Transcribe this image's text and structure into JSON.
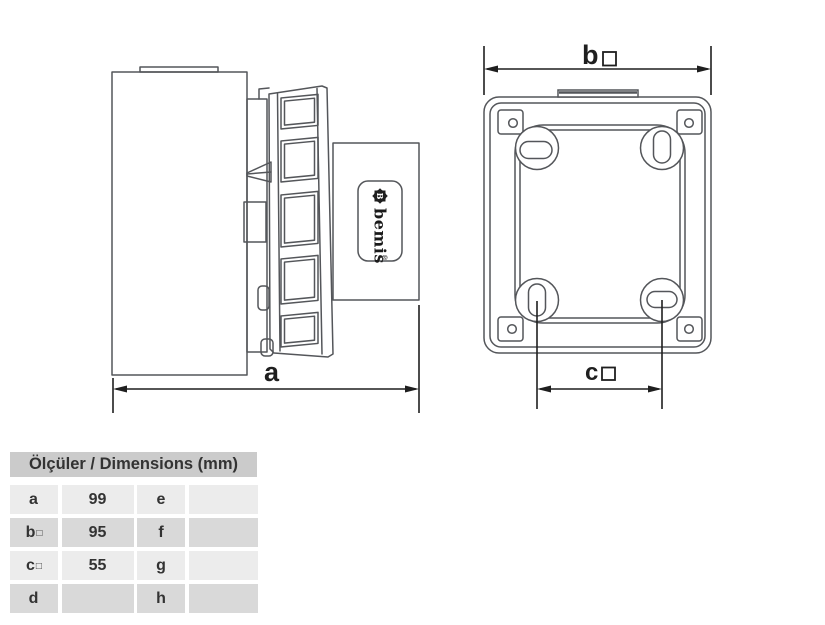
{
  "drawing": {
    "dim_a": {
      "label": "a"
    },
    "dim_b": {
      "label": "b",
      "symbol": "□"
    },
    "dim_c": {
      "label": "c",
      "symbol": "□"
    },
    "logo": {
      "monogram": "B",
      "text": "bemis",
      "reg": "®"
    }
  },
  "table": {
    "title": "Ölçüler / Dimensions (mm)",
    "rows": [
      {
        "k1": "a",
        "k1_sym": "",
        "v1": "99",
        "k2": "e",
        "v2": ""
      },
      {
        "k1": "b",
        "k1_sym": "□",
        "v1": "95",
        "k2": "f",
        "v2": ""
      },
      {
        "k1": "c",
        "k1_sym": "□",
        "v1": "55",
        "k2": "g",
        "v2": ""
      },
      {
        "k1": "d",
        "k1_sym": "",
        "v1": "",
        "k2": "h",
        "v2": ""
      }
    ]
  },
  "colors": {
    "line_gray": "#54565a",
    "dimension_black": "#1f1f1f",
    "table_header_bg": "#cbcbcb",
    "row_light": "#ececec",
    "row_dark": "#d9d9d9",
    "text": "#333333",
    "background": "#ffffff"
  }
}
